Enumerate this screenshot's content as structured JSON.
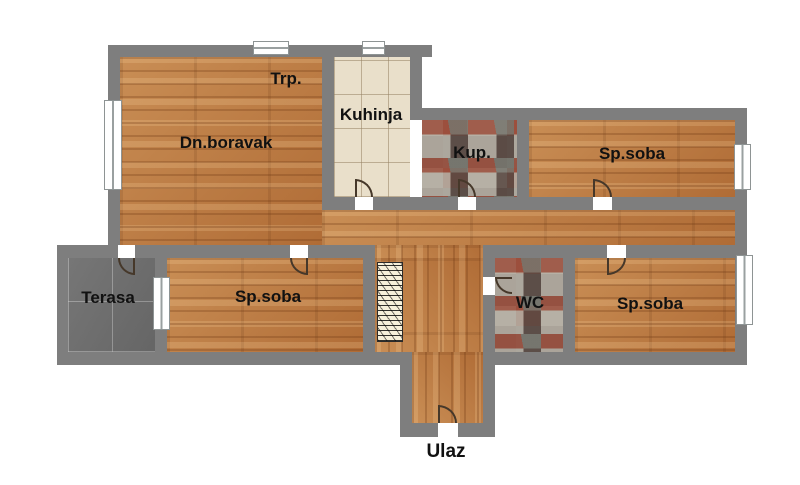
{
  "plan": {
    "title": "Apartment floor plan",
    "rooms": {
      "trp": {
        "label": "Trp."
      },
      "living": {
        "label": "Dn.boravak"
      },
      "kitchen": {
        "label": "Kuhinja"
      },
      "bathroom": {
        "label": "Kup."
      },
      "bedroom_top": {
        "label": "Sp.soba"
      },
      "terrace": {
        "label": "Terasa"
      },
      "bedroom_mid": {
        "label": "Sp.soba"
      },
      "wc": {
        "label": "WC"
      },
      "bedroom_right": {
        "label": "Sp.soba"
      },
      "entrance": {
        "label": "Ulaz"
      }
    },
    "colors": {
      "wall": "#7e7e7e",
      "wood_floor": "#bd7c45",
      "kitchen_tile": "#e9dfca",
      "stone_tile": "#9b9189",
      "terrace_tile": "#6e6e6e",
      "label_text": "#111111",
      "background": "#ffffff"
    }
  }
}
